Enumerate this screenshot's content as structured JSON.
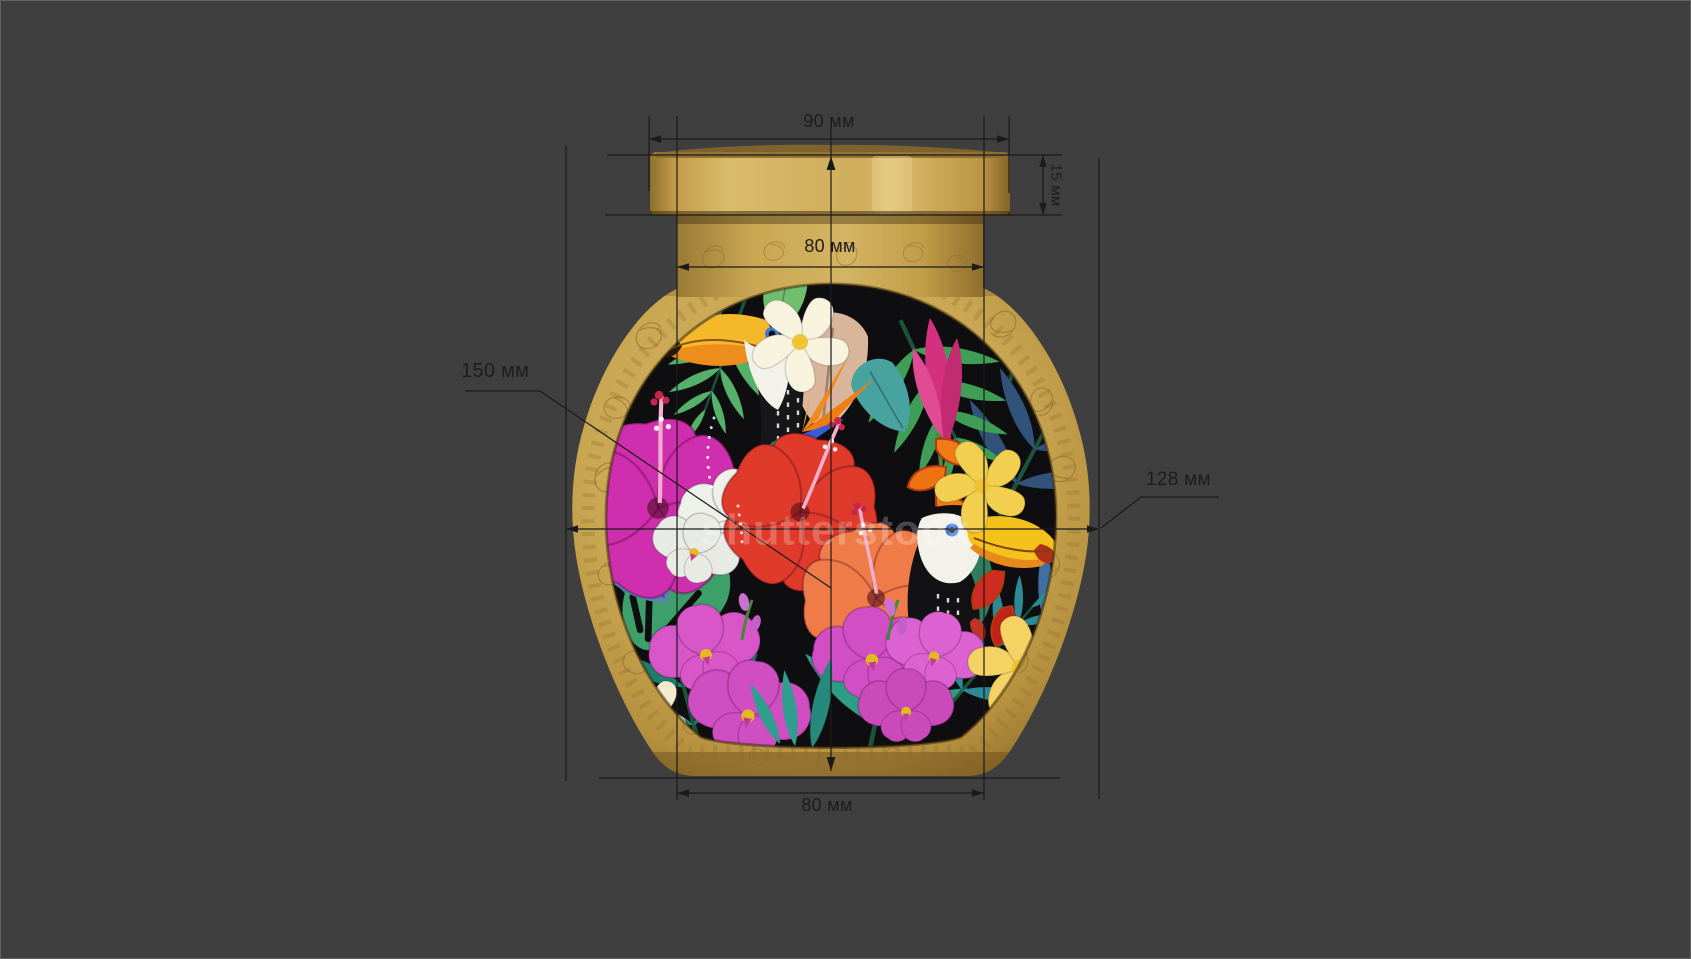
{
  "scene": {
    "background": "#3f3f3f",
    "line_color": "#1b1b1b",
    "text_color": "#1d1d1d"
  },
  "jar": {
    "gold": "#c9a450",
    "gold_dark": "#8f6f2d",
    "gold_light": "#ddc074",
    "label_background": "#0e0e11",
    "watermark": "shutterstock"
  },
  "dimensions": {
    "lid_width": "90 мм",
    "lid_height": "15 мм",
    "neck_width": "80 мм",
    "body_height": "150 мм",
    "body_width": "128 мм",
    "base_width": "80 мм"
  }
}
